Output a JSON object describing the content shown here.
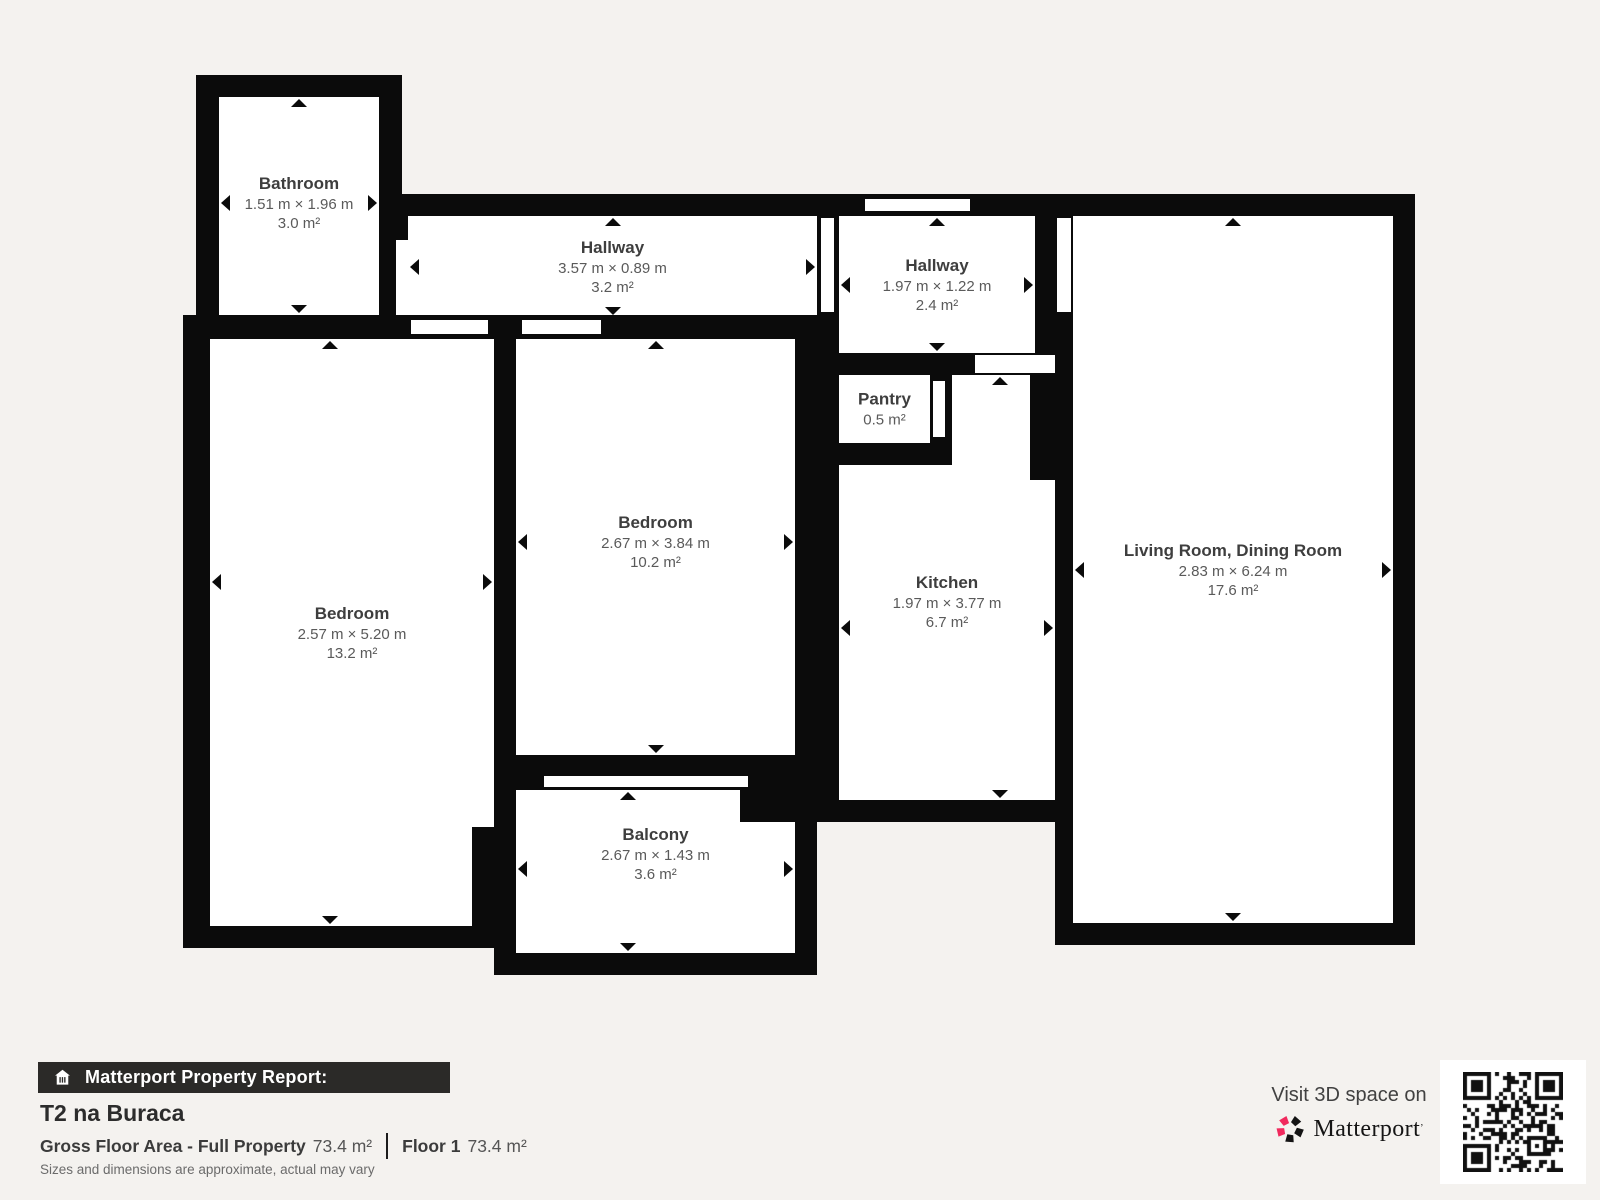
{
  "colors": {
    "background": "#f4f2ef",
    "wall": "#0b0b0b",
    "room_fill": "#ffffff",
    "room_name_color": "#3e3e3e",
    "room_dims_color": "#5a5a5a",
    "bar_bg": "#2b2a28",
    "bar_text": "#ffffff",
    "brand_red": "#f1295d",
    "text_dark": "#2c2c2c",
    "text_mid": "#555555",
    "text_light": "#6b6b6b"
  },
  "rooms": [
    {
      "name": "Bathroom",
      "dims": "1.51 m × 1.96 m",
      "area": "3.0 m²"
    },
    {
      "name": "Hallway",
      "dims": "3.57 m × 0.89 m",
      "area": "3.2 m²"
    },
    {
      "name": "Hallway",
      "dims": "1.97 m × 1.22 m",
      "area": "2.4 m²"
    },
    {
      "name": "Pantry",
      "dims": null,
      "area": "0.5 m²"
    },
    {
      "name": "Bedroom",
      "dims": "2.67 m × 3.84 m",
      "area": "10.2 m²"
    },
    {
      "name": "Bedroom",
      "dims": "2.57 m × 5.20 m",
      "area": "13.2 m²"
    },
    {
      "name": "Kitchen",
      "dims": "1.97 m × 3.77 m",
      "area": "6.7 m²"
    },
    {
      "name": "Living Room, Dining Room",
      "dims": "2.83 m × 6.24 m",
      "area": "17.6 m²"
    },
    {
      "name": "Balcony",
      "dims": "2.67 m × 1.43 m",
      "area": "3.6 m²"
    }
  ],
  "footer": {
    "report_label": "Matterport Property Report:",
    "property_title": "T2 na Buraca",
    "gross_label": "Gross Floor Area - Full Property",
    "gross_value": "73.4 m²",
    "floor_label": "Floor 1",
    "floor_value": "73.4 m²",
    "disclaimer": "Sizes and dimensions are approximate, actual may vary"
  },
  "promo": {
    "visit_text": "Visit 3D space on",
    "brand": "Matterport",
    "brand_mark": "’"
  }
}
